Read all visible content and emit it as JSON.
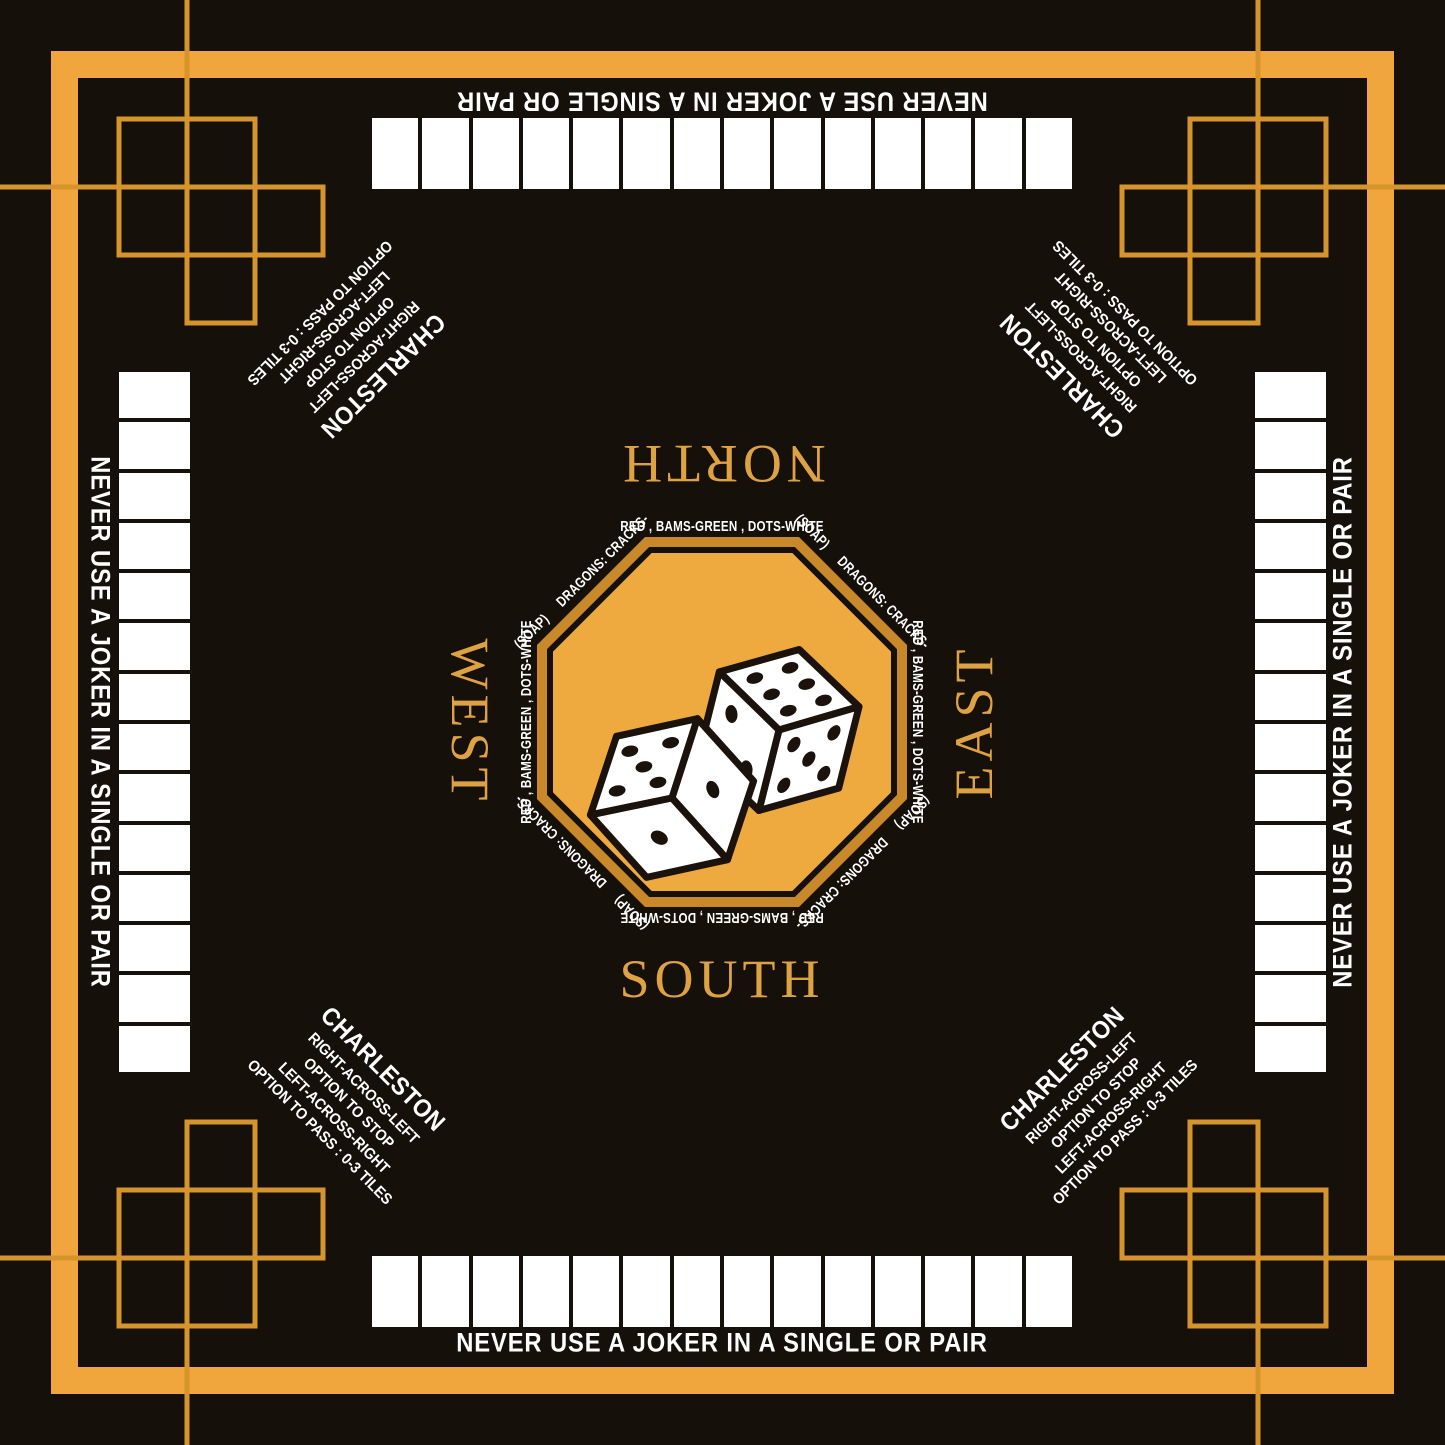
{
  "colors": {
    "gold_border": "#F0A63C",
    "gold_fill": "#EEA93F",
    "gold_edge_band": "#C9892B",
    "gold_deco_line": "#D6942D",
    "gold_compass_text": "#DFA243",
    "background_black": "#16100B",
    "tile_white": "#FFFFFF",
    "text_white": "#FFFFFF"
  },
  "board": {
    "tiles_per_side": 14,
    "racks": 4
  },
  "sides": {
    "joker_warning": "NEVER USE A JOKER IN A SINGLE OR PAIR"
  },
  "compass": {
    "north": "NORTH",
    "south": "SOUTH",
    "east": "EAST",
    "west": "WEST"
  },
  "charleston": {
    "title": "CHARLESTON",
    "lines": [
      "RIGHT-ACROSS-LEFT",
      "OPTION TO STOP",
      "LEFT-ACROSS-RIGHT",
      "OPTION TO PASS :  0-3 TILES"
    ]
  },
  "octagon": {
    "edge_text": "RED , BAMS-GREEN , DOTS-WHITE",
    "soap": "(SOAP)",
    "dragons": "DRAGONS: CRACKS-"
  },
  "dice": {
    "left_die_top_face": 5,
    "right_die_top_face": 6
  }
}
